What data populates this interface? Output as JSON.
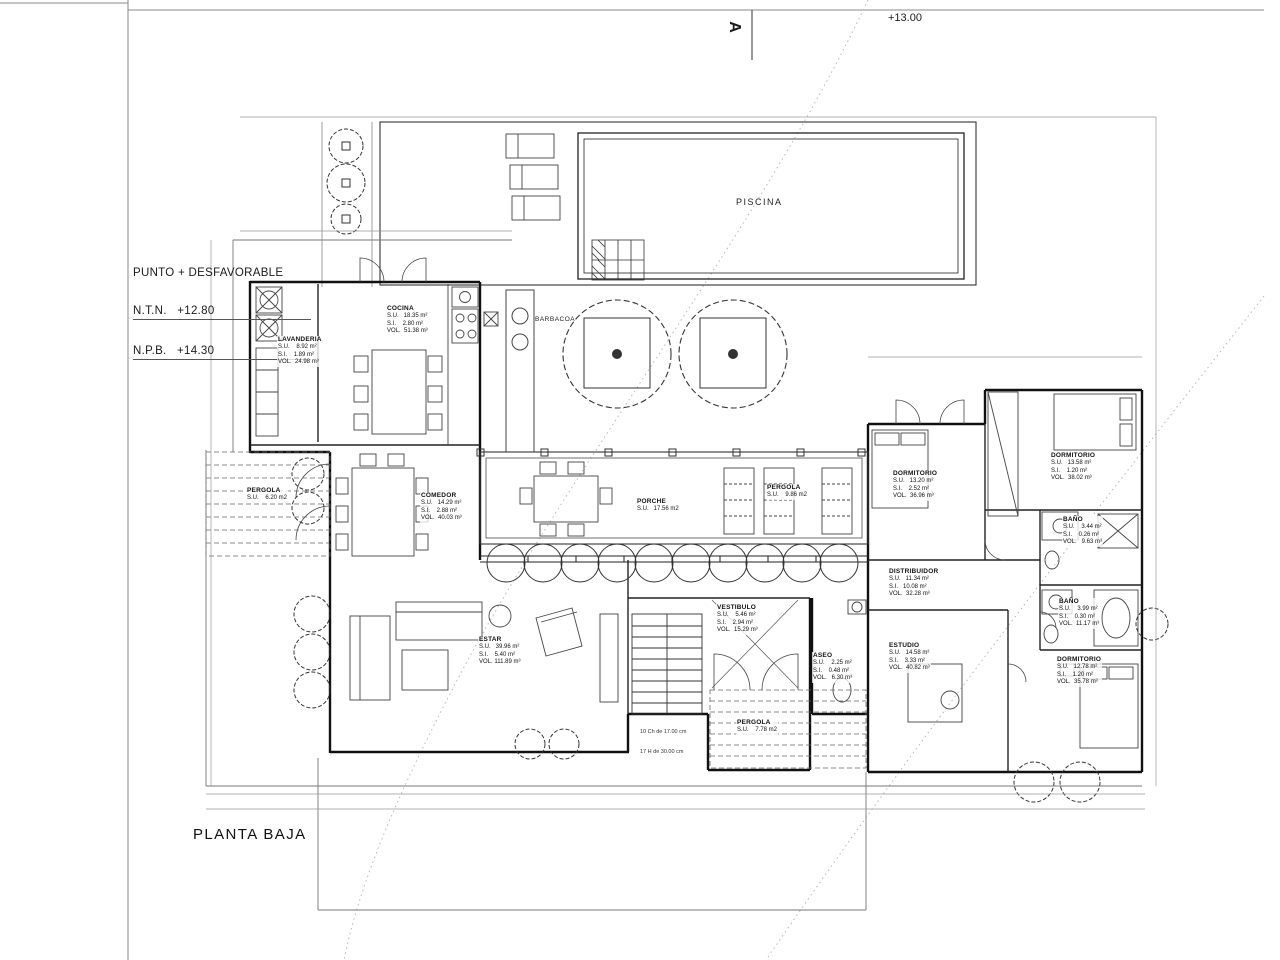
{
  "title_block": {
    "drawing_title": "PLANTA BAJA",
    "section_marker": "A",
    "level_annotation": "+13.00",
    "datum_note": {
      "line1": "PUNTO + DESFAVORABLE",
      "line2": "N.T.N.   +12.80",
      "line3": "N.P.B.   +14.30"
    }
  },
  "areas": {
    "piscina": "PISCINA",
    "barbacoa": "BARBACOA"
  },
  "stair_note": [
    "10 Ch de 17.00 cm",
    "17 H de 30.00 cm"
  ],
  "rooms": [
    {
      "name": "LAVANDERIA",
      "x": 277,
      "y": 336,
      "lines": [
        "S.U.    8.92 m²",
        "S.I.    1.89 m²",
        "VOL.  24.98 m³"
      ]
    },
    {
      "name": "COCINA",
      "x": 386,
      "y": 305,
      "lines": [
        "S.U.   18.35 m²",
        "S.I.    2.80 m²",
        "VOL.  51.38 m³"
      ]
    },
    {
      "name": "COMEDOR",
      "x": 420,
      "y": 492,
      "lines": [
        "S.U.   14.29 m²",
        "S.I.    2.88 m²",
        "VOL.  40.03 m³"
      ]
    },
    {
      "name": "PORCHE",
      "x": 636,
      "y": 498,
      "lines": [
        "S.U.   17.56 m2"
      ]
    },
    {
      "name": "PERGOLA",
      "x": 766,
      "y": 484,
      "lines": [
        "S.U.    9.86 m2"
      ]
    },
    {
      "name": "ESTAR",
      "x": 478,
      "y": 636,
      "lines": [
        "S.U.   39.96 m²",
        "S.I.    5.40 m²",
        "VOL. 111.89 m³"
      ]
    },
    {
      "name": "VESTIBULO",
      "x": 716,
      "y": 604,
      "lines": [
        "S.U.    5.46 m²",
        "S.I.    2.94 m²",
        "VOL.  15.29 m³"
      ]
    },
    {
      "name": "ASEO",
      "x": 812,
      "y": 652,
      "lines": [
        "S.U.    2.25 m²",
        "S.I.    0.48 m²",
        "VOL.   6.30 m³"
      ]
    },
    {
      "name": "DISTRIBUIDOR",
      "x": 888,
      "y": 568,
      "lines": [
        "S.U.   11.34 m²",
        "S.I.   10.08 m²",
        "VOL.  32.28 m³"
      ]
    },
    {
      "name": "ESTUDIO",
      "x": 888,
      "y": 642,
      "lines": [
        "S.U.   14.58 m²",
        "S.I.    3.33 m²",
        "VOL.  40.82 m³"
      ]
    },
    {
      "name": "DORMITORIO",
      "x": 892,
      "y": 470,
      "lines": [
        "S.U.   13.20 m²",
        "S.I.    2.52 m²",
        "VOL.  36.96 m³"
      ]
    },
    {
      "name": "DORMITORIO",
      "x": 1050,
      "y": 452,
      "lines": [
        "S.U.   13.58 m²",
        "S.I.    1.20 m²",
        "VOL.  38.02 m³"
      ]
    },
    {
      "name": "BAÑO",
      "x": 1062,
      "y": 516,
      "lines": [
        "S.U.    3.44 m²",
        "S.I.    0.26 m²",
        "VOL.   9.63 m³"
      ]
    },
    {
      "name": "BAÑO",
      "x": 1058,
      "y": 598,
      "lines": [
        "S.U.    3.99 m²",
        "S.I.    0.30 m²",
        "VOL.  11.17 m³"
      ]
    },
    {
      "name": "DORMITORIO",
      "x": 1056,
      "y": 656,
      "lines": [
        "S.U.   12.78 m²",
        "S.I.    1.20 m²",
        "VOL.  35.78 m³"
      ]
    },
    {
      "name": "PERGOLA",
      "x": 246,
      "y": 487,
      "lines": [
        "S.U.    6.20 m2"
      ]
    },
    {
      "name": "PERGOLA",
      "x": 736,
      "y": 719,
      "lines": [
        "S.U.    7.78 m2"
      ]
    }
  ],
  "dims": [
    {
      "t": "3.90",
      "x": 300,
      "y": 107
    },
    {
      "t": "5.75",
      "x": 472,
      "y": 107
    },
    {
      "t": "11.00",
      "x": 766,
      "y": 107
    },
    {
      "t": "4.15",
      "x": 1046,
      "y": 107
    },
    {
      "t": "0.30",
      "x": 1128,
      "y": 107
    },
    {
      "t": "1.80",
      "x": 288,
      "y": 227
    },
    {
      "t": "1.20",
      "x": 326,
      "y": 227
    },
    {
      "t": "1.20",
      "x": 360,
      "y": 227
    },
    {
      "t": "0.30",
      "x": 400,
      "y": 227
    },
    {
      "t": "0.90",
      "x": 488,
      "y": 227
    },
    {
      "t": "10.70",
      "x": 664,
      "y": 431
    },
    {
      "t": "2.60",
      "x": 512,
      "y": 445
    },
    {
      "t": "0.60",
      "x": 552,
      "y": 445
    },
    {
      "t": "2.57",
      "x": 596,
      "y": 445
    },
    {
      "t": "0.60",
      "x": 644,
      "y": 445
    },
    {
      "t": "0.60",
      "x": 676,
      "y": 445
    },
    {
      "t": "2.77",
      "x": 754,
      "y": 445
    },
    {
      "t": "0.60",
      "x": 814,
      "y": 445
    },
    {
      "t": "0.60",
      "x": 846,
      "y": 445
    },
    {
      "t": "3.03",
      "x": 908,
      "y": 346
    },
    {
      "t": "4.77",
      "x": 1048,
      "y": 346
    },
    {
      "t": "1.42",
      "x": 884,
      "y": 359
    },
    {
      "t": "1.20",
      "x": 920,
      "y": 359
    },
    {
      "t": "0.30",
      "x": 950,
      "y": 359
    },
    {
      "t": "0.30",
      "x": 998,
      "y": 359
    },
    {
      "t": "1.20",
      "x": 1036,
      "y": 359
    },
    {
      "t": "1.42",
      "x": 1094,
      "y": 359
    },
    {
      "t": "0.30",
      "x": 208,
      "y": 790
    },
    {
      "t": "8.05",
      "x": 260,
      "y": 790
    },
    {
      "t": "1.80",
      "x": 298,
      "y": 790
    },
    {
      "t": "0.30",
      "x": 318,
      "y": 790
    },
    {
      "t": "4.20",
      "x": 386,
      "y": 790
    },
    {
      "t": "1.35",
      "x": 444,
      "y": 790
    },
    {
      "t": "3.90",
      "x": 554,
      "y": 790
    },
    {
      "t": "1.20",
      "x": 608,
      "y": 790
    },
    {
      "t": "3.75",
      "x": 646,
      "y": 790
    },
    {
      "t": "7.05",
      "x": 704,
      "y": 790
    },
    {
      "t": "0.30",
      "x": 736,
      "y": 790
    },
    {
      "t": "3.40",
      "x": 760,
      "y": 790
    },
    {
      "t": "2.77",
      "x": 804,
      "y": 790
    },
    {
      "t": "1.50",
      "x": 842,
      "y": 790
    },
    {
      "t": "0.30",
      "x": 864,
      "y": 790
    },
    {
      "t": "3.45",
      "x": 898,
      "y": 790
    },
    {
      "t": "3.42",
      "x": 970,
      "y": 790
    },
    {
      "t": "3.43",
      "x": 1056,
      "y": 790
    },
    {
      "t": "1.20",
      "x": 1096,
      "y": 790
    },
    {
      "t": "1.42",
      "x": 1126,
      "y": 790
    },
    {
      "t": "4.80",
      "x": 310,
      "y": 805
    },
    {
      "t": "6.10",
      "x": 588,
      "y": 805
    },
    {
      "t": "0.40",
      "x": 698,
      "y": 805
    },
    {
      "t": "4.20",
      "x": 786,
      "y": 805
    },
    {
      "t": "3.75",
      "x": 874,
      "y": 805
    },
    {
      "t": "6.10",
      "x": 1036,
      "y": 805
    },
    {
      "t": "3.90",
      "x": 222,
      "y": 192,
      "r": -90
    },
    {
      "t": "2.45",
      "x": 204,
      "y": 486,
      "r": -90
    },
    {
      "t": "0.80",
      "x": 204,
      "y": 548,
      "r": -90
    },
    {
      "t": "3.10",
      "x": 204,
      "y": 602,
      "r": -90
    },
    {
      "t": "2.81",
      "x": 204,
      "y": 664,
      "r": -90
    },
    {
      "t": "3.75",
      "x": 204,
      "y": 732,
      "r": -90
    },
    {
      "t": "0.30",
      "x": 1148,
      "y": 126,
      "r": -90
    },
    {
      "t": "4.00",
      "x": 1148,
      "y": 188,
      "r": -90
    },
    {
      "t": "6.30",
      "x": 1148,
      "y": 258,
      "r": -90
    },
    {
      "t": "3.15",
      "x": 1148,
      "y": 450,
      "r": -90
    },
    {
      "t": "3.10",
      "x": 1148,
      "y": 538,
      "r": -90
    },
    {
      "t": "0.60",
      "x": 1148,
      "y": 598,
      "r": -90
    },
    {
      "t": "3.43",
      "x": 1148,
      "y": 690,
      "r": -90
    },
    {
      "t": "1.20",
      "x": 1148,
      "y": 734,
      "r": -90
    },
    {
      "t": "1.45",
      "x": 514,
      "y": 330,
      "r": -90
    },
    {
      "t": "1.60",
      "x": 514,
      "y": 414,
      "r": -90
    }
  ],
  "colors": {
    "background": "#ffffff",
    "walls": "#111111",
    "partitions": "#222222",
    "furniture": "#555555",
    "boundary": "#777777",
    "dimension_text": "#333333",
    "section_curve": "#b8b8b8"
  }
}
